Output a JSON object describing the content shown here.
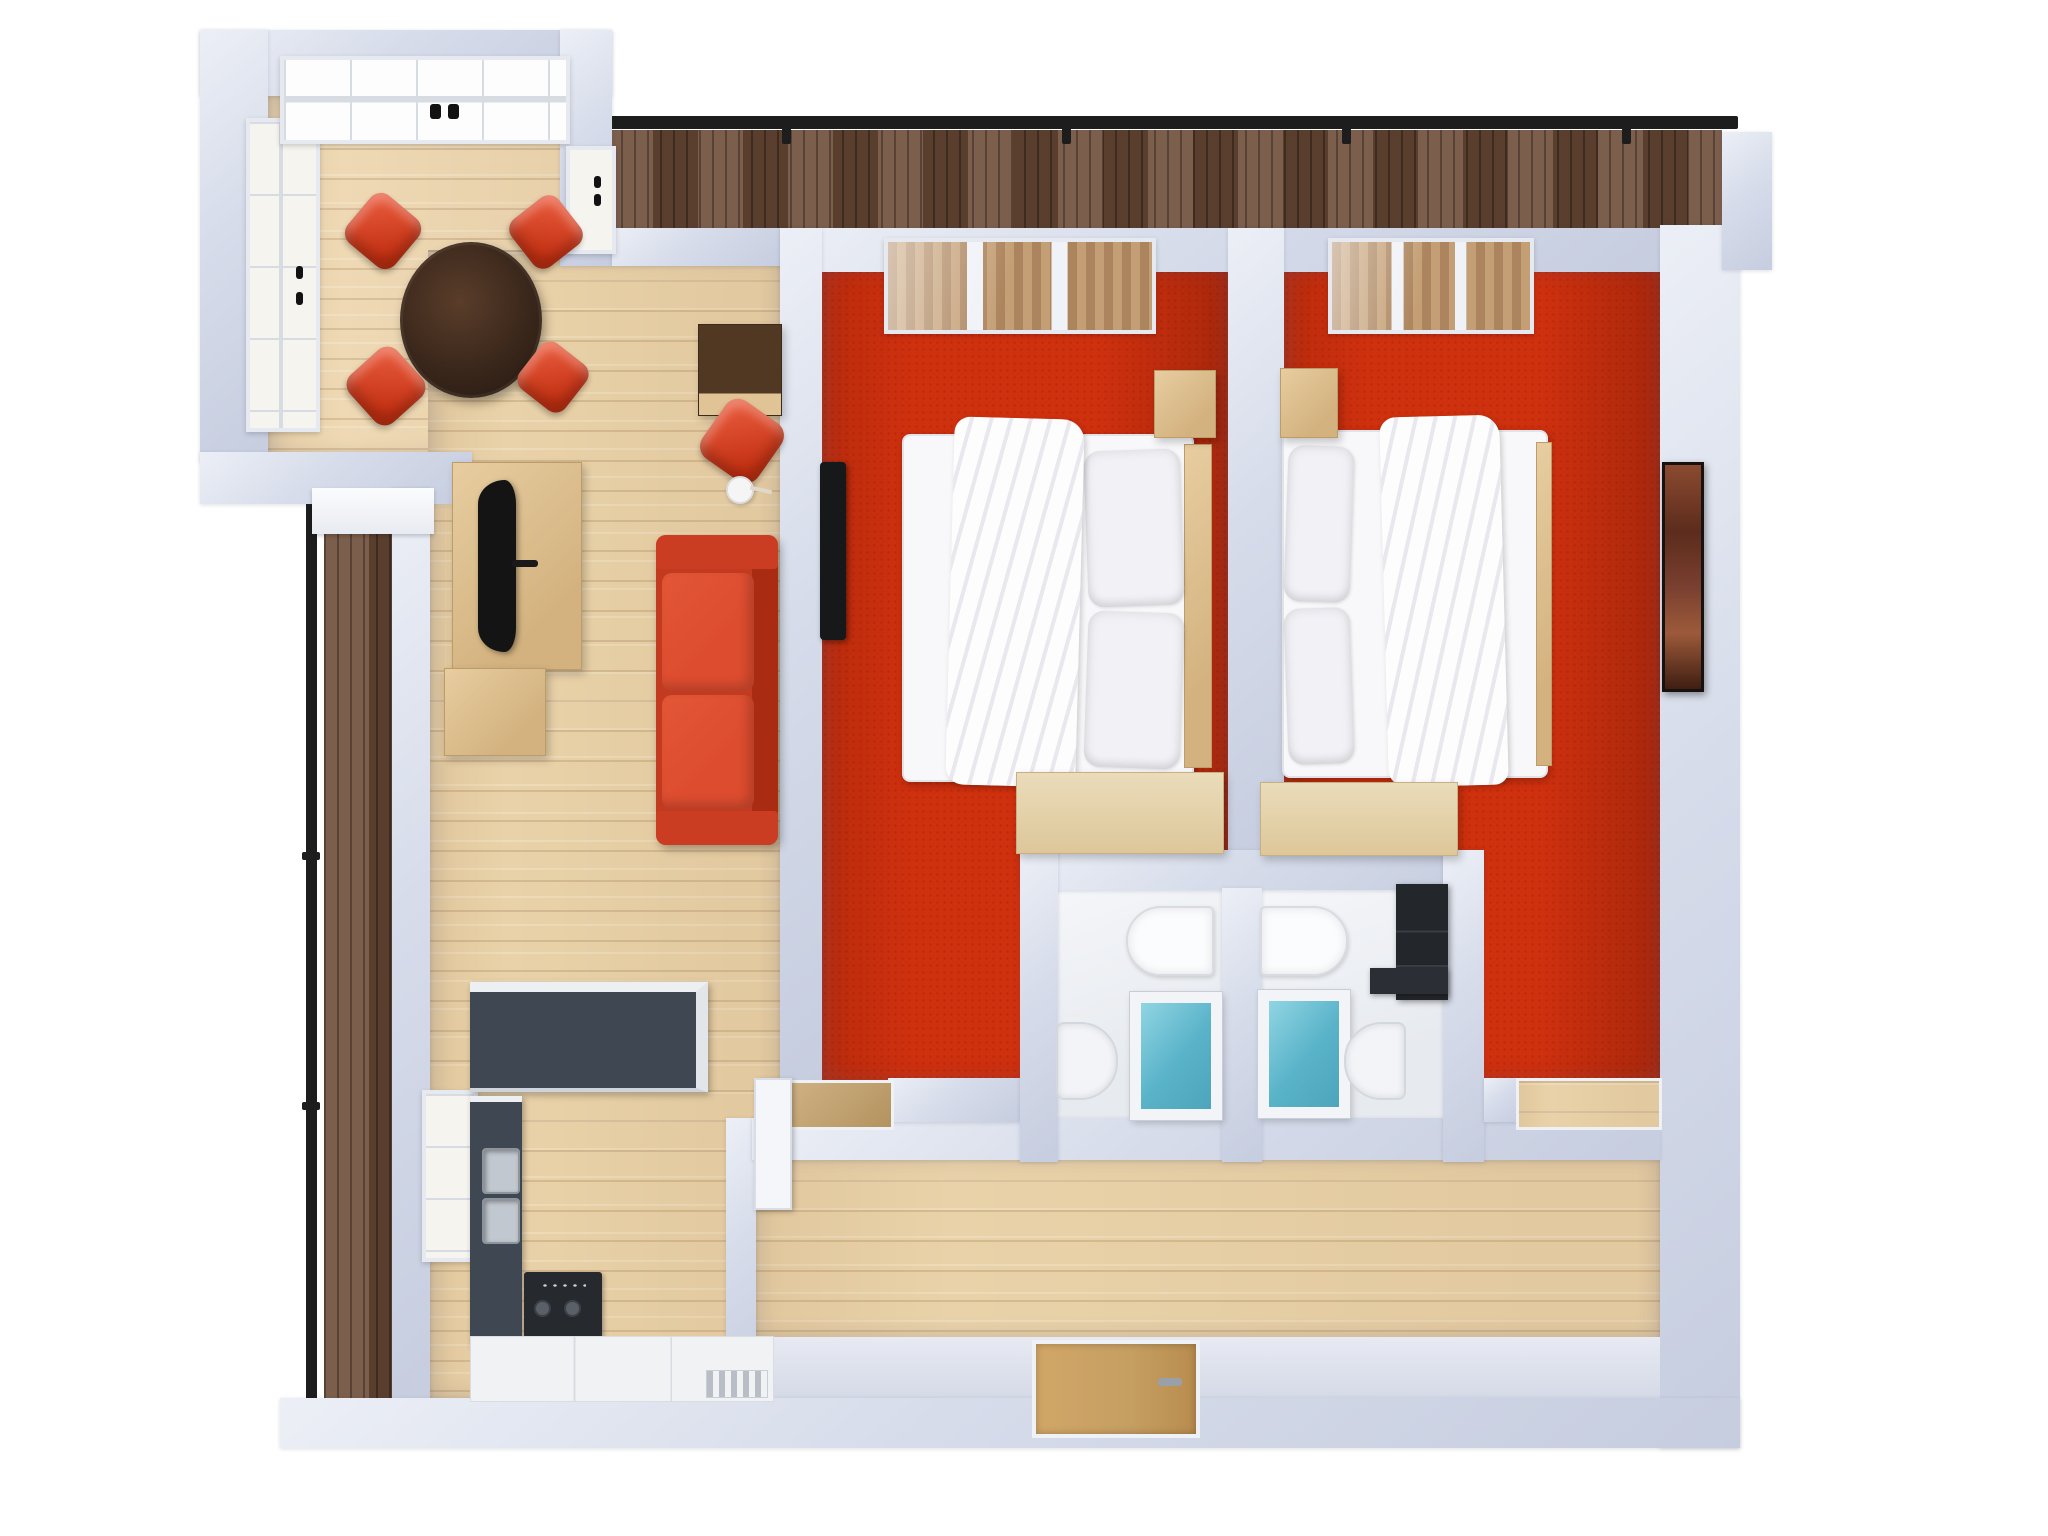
{
  "meta": {
    "description": "Top-down 3D rendered floor plan of a two-bedroom apartment",
    "visible_text": "none"
  },
  "colors": {
    "page_bg": "#ffffff",
    "wall": "#d2d8e6",
    "wall_light": "#e9ecf4",
    "floor_wood": "#e9d2a9",
    "deck_wood": "#6d4c38",
    "carpet_red": "#cf300e",
    "bath_floor": "#eef0f3",
    "sofa_red": "#c23a1f",
    "sofa_red_dark": "#a92c12",
    "cushion_red": "#dd4c2f",
    "chair_red": "#d8422c",
    "table_wood": "#3a271b",
    "counter_dark": "#3e4752",
    "cabinet_wood": "#e0c496",
    "water_blue": "#58b2c8",
    "door_tan": "#c59e62",
    "railing_black": "#1d1d1d",
    "appliance_black": "#26292e",
    "glass": "#f6f4ee",
    "art_brown": "#7a4030"
  },
  "rooms": [
    {
      "id": "dining-bay",
      "name": "Dining bay"
    },
    {
      "id": "living-room",
      "name": "Living room"
    },
    {
      "id": "kitchen",
      "name": "Kitchen"
    },
    {
      "id": "bedroom-1",
      "name": "Bedroom 1"
    },
    {
      "id": "bedroom-2",
      "name": "Bedroom 2"
    },
    {
      "id": "bathroom-1",
      "name": "Bathroom 1"
    },
    {
      "id": "bathroom-2",
      "name": "Bathroom 2"
    },
    {
      "id": "hallway",
      "name": "Hallway"
    },
    {
      "id": "balcony-left",
      "name": "Side balcony"
    },
    {
      "id": "balcony-top",
      "name": "Top balcony"
    }
  ],
  "furniture": {
    "dining": [
      "round-dining-table",
      "dining-chair",
      "dining-chair",
      "dining-chair",
      "dining-chair"
    ],
    "living": [
      "tv-lowboard",
      "curved-tv",
      "media-cabinet",
      "sideboard",
      "red-armchair",
      "floor-lamp",
      "red-sofa"
    ],
    "kitchen": [
      "island-counter",
      "wall-counter",
      "double-sink",
      "cooktop",
      "base-cabinets",
      "vent-grille"
    ],
    "bedroom_1": [
      "double-bed",
      "duvet",
      "pillows",
      "headboard",
      "nightstand",
      "wall-tv",
      "desk",
      "door-mat",
      "door-leaf"
    ],
    "bedroom_2": [
      "double-bed",
      "duvet",
      "pillows",
      "foot-rail",
      "nightstand",
      "desk",
      "wall-art",
      "door-mat"
    ],
    "bathroom_1": [
      "washbasin",
      "bathtub",
      "toilet"
    ],
    "bathroom_2": [
      "washbasin",
      "bathtub",
      "toilet",
      "dark-wardrobe",
      "dark-counter"
    ],
    "hallway": [
      "entrance-door",
      "door-handle"
    ]
  },
  "counts": {
    "bedrooms": 2,
    "bathrooms": 2,
    "balconies": 2,
    "dining_chairs": 4
  }
}
